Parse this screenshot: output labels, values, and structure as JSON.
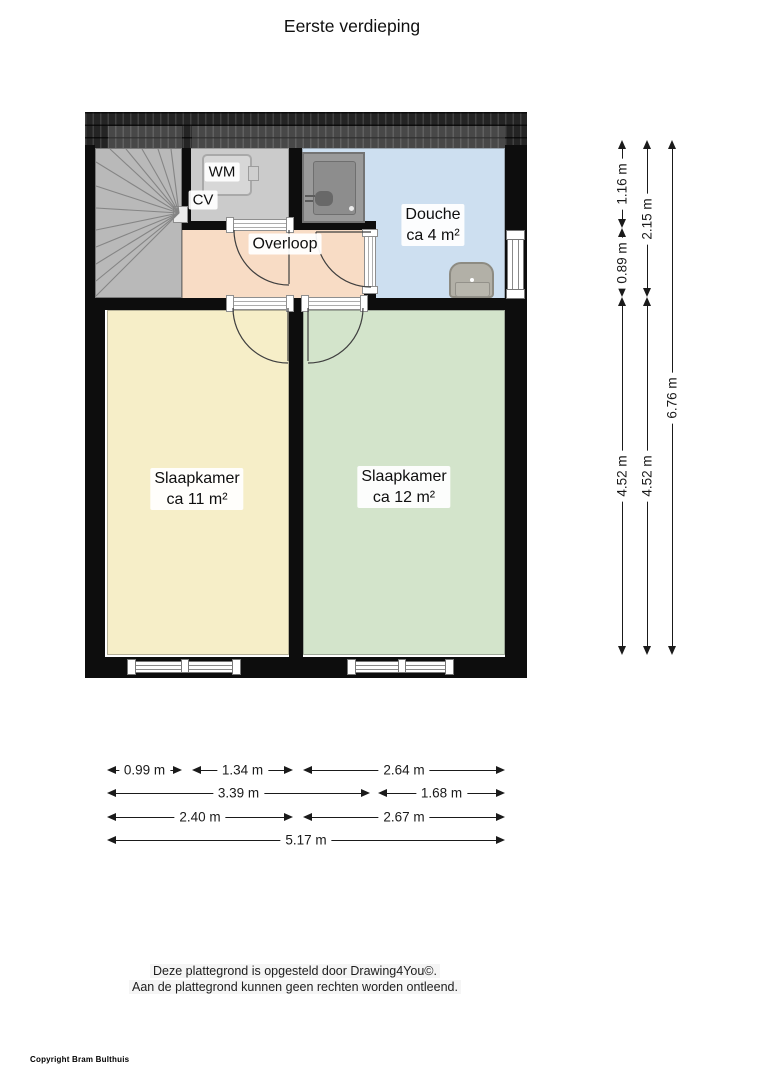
{
  "title": "Eerste verdieping",
  "rooms": {
    "wm": "WM",
    "cv": "CV",
    "overloop": "Overloop",
    "douche_name": "Douche",
    "douche_area": "ca 4 m²",
    "bedroom1_name": "Slaapkamer",
    "bedroom1_area": "ca 11 m²",
    "bedroom2_name": "Slaapkamer",
    "bedroom2_area": "ca 12 m²"
  },
  "dimensions": {
    "right": [
      {
        "label": "1.16 m"
      },
      {
        "label": "0.89 m"
      },
      {
        "label": "4.52 m"
      },
      {
        "label": "2.15 m"
      },
      {
        "label": "4.52 m"
      },
      {
        "label": "6.76 m"
      }
    ],
    "bottom": [
      {
        "label": "0.99 m"
      },
      {
        "label": "1.34 m"
      },
      {
        "label": "2.64 m"
      },
      {
        "label": "3.39 m"
      },
      {
        "label": "1.68 m"
      },
      {
        "label": "2.40 m"
      },
      {
        "label": "2.67 m"
      },
      {
        "label": "5.17 m"
      }
    ]
  },
  "footer": {
    "line1": "Deze plattegrond is opgesteld door Drawing4You©.",
    "line2": "Aan de plattegrond kunnen geen rechten worden ontleend."
  },
  "copyright": "Copyright Bram Bulthuis",
  "colors": {
    "wall": "#0d0d0d",
    "roof": "#242424",
    "stairs": "#b9b9b9",
    "wm_room": "#cbcbcb",
    "overloop": "#f8dcc5",
    "douche": "#cddff0",
    "bedroom1": "#f6eec8",
    "bedroom2": "#d3e4cb"
  }
}
